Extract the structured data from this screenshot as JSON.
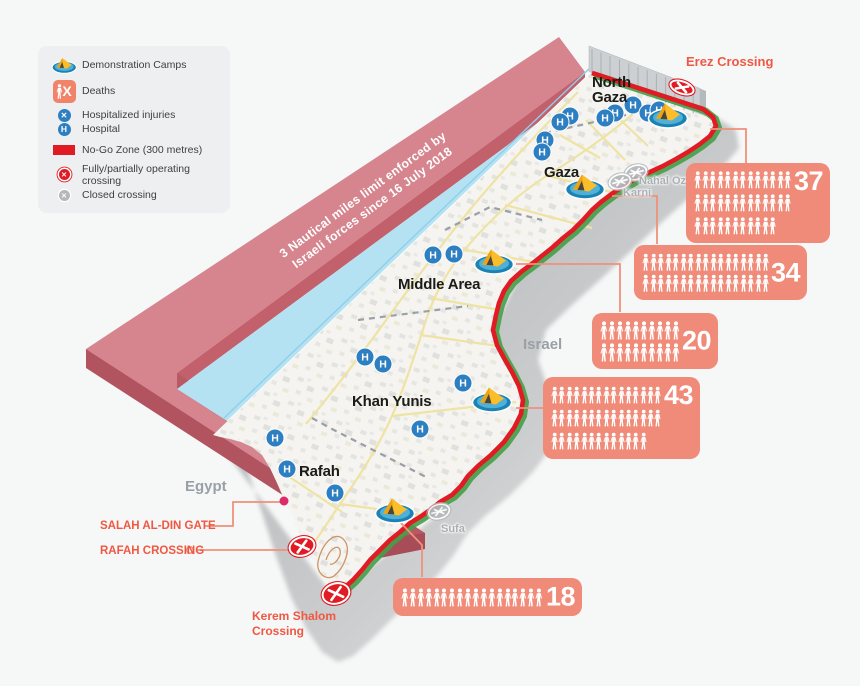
{
  "legend": {
    "items": [
      {
        "icon": "tent-icon",
        "label": "Demonstration Camps"
      },
      {
        "icon": "deaths-icon",
        "label": "Deaths"
      },
      {
        "icon": "injury-icon",
        "label": "Hospitalized injuries"
      },
      {
        "icon": "hospital-icon",
        "label": "Hospital"
      },
      {
        "icon": "nogo-icon",
        "label": "No-Go Zone (300 metres)"
      },
      {
        "icon": "operating-crossing-icon",
        "label": "Fully/partially operating crossing"
      },
      {
        "icon": "closed-crossing-icon",
        "label": "Closed crossing"
      }
    ]
  },
  "sea_band": {
    "label": "3 Nautical miles limit enforced by\nIsraeli forces since 16 July 2018"
  },
  "regions": [
    {
      "name": "North\nGaza",
      "x": 592,
      "y": 76
    },
    {
      "name": "Gaza",
      "x": 544,
      "y": 166
    },
    {
      "name": "Middle Area",
      "x": 398,
      "y": 278
    },
    {
      "name": "Khan Yunis",
      "x": 352,
      "y": 395
    },
    {
      "name": "Rafah",
      "x": 299,
      "y": 465
    }
  ],
  "countries": [
    {
      "name": "Israel",
      "x": 523,
      "y": 336
    },
    {
      "name": "Egypt",
      "x": 185,
      "y": 478
    }
  ],
  "crossing_labels": [
    {
      "id": "erez",
      "name": "Erez Crossing",
      "x": 686,
      "y": 54,
      "size": 13
    },
    {
      "id": "salah-al-din-gate",
      "name": "SALAH AL-DIN GATE",
      "x": 100,
      "y": 519,
      "size": 11.5
    },
    {
      "id": "rafah-crossing",
      "name": "RAFAH CROSSING",
      "x": 100,
      "y": 544,
      "size": 11.5
    },
    {
      "id": "kerem-shalom",
      "name": "Kerem Shalom\nCrossing",
      "x": 252,
      "y": 609,
      "size": 12
    }
  ],
  "closed_crossings": [
    {
      "name": "Nahal Oz",
      "icon_x": 636,
      "icon_y": 175,
      "label_x": 639,
      "label_y": 175
    },
    {
      "name": "Karni",
      "icon_x": 620,
      "icon_y": 184,
      "label_x": 623,
      "label_y": 187
    },
    {
      "name": "Sufa",
      "icon_x": 439,
      "icon_y": 514,
      "label_x": 441,
      "label_y": 523
    }
  ],
  "operating_crossings": [
    {
      "id": "erez-crossing-marker",
      "x": 682,
      "y": 90,
      "rx": 12,
      "ry": 6,
      "rot": 20
    },
    {
      "id": "rafah-crossing-marker",
      "x": 302,
      "y": 549,
      "rx": 12.5,
      "ry": 9,
      "rot": -15
    },
    {
      "id": "kerem-shalom-crossing-marker",
      "x": 336,
      "y": 596,
      "rx": 13.5,
      "ry": 10,
      "rot": -15
    }
  ],
  "gate_marker": {
    "x": 284,
    "y": 501
  },
  "camps": [
    {
      "x": 668,
      "y": 117
    },
    {
      "x": 585,
      "y": 188
    },
    {
      "x": 494,
      "y": 263
    },
    {
      "x": 492,
      "y": 401
    },
    {
      "x": 395,
      "y": 512
    }
  ],
  "hospitals": [
    {
      "x": 633,
      "y": 105
    },
    {
      "x": 648,
      "y": 113
    },
    {
      "x": 659,
      "y": 110
    },
    {
      "x": 615,
      "y": 113
    },
    {
      "x": 605,
      "y": 118
    },
    {
      "x": 570,
      "y": 116
    },
    {
      "x": 560,
      "y": 122
    },
    {
      "x": 545,
      "y": 140
    },
    {
      "x": 542,
      "y": 152
    },
    {
      "x": 433,
      "y": 255
    },
    {
      "x": 454,
      "y": 254
    },
    {
      "x": 365,
      "y": 357
    },
    {
      "x": 383,
      "y": 364
    },
    {
      "x": 463,
      "y": 383
    },
    {
      "x": 420,
      "y": 429
    },
    {
      "x": 275,
      "y": 438
    },
    {
      "x": 287,
      "y": 469
    },
    {
      "x": 335,
      "y": 493
    }
  ],
  "hospital_glyph": "H",
  "stats": [
    {
      "value": "37",
      "rows": [
        13,
        13,
        11
      ],
      "x": 686,
      "y": 163,
      "w": 144,
      "h": 80,
      "num_pos": "top"
    },
    {
      "value": "34",
      "rows": [
        17,
        17
      ],
      "x": 634,
      "y": 245,
      "w": 173,
      "h": 55,
      "num_pos": "mid"
    },
    {
      "value": "20",
      "rows": [
        10,
        10
      ],
      "x": 592,
      "y": 313,
      "w": 126,
      "h": 56,
      "num_pos": "mid"
    },
    {
      "value": "43",
      "rows": [
        15,
        15,
        13
      ],
      "x": 543,
      "y": 377,
      "w": 157,
      "h": 82,
      "num_pos": "top"
    },
    {
      "value": "18",
      "rows": [
        18
      ],
      "x": 393,
      "y": 578,
      "w": 189,
      "h": 38,
      "num_pos": "mid"
    }
  ],
  "colors": {
    "accent_label": "#f05843",
    "stat_box": "#ef8b78",
    "nogo_red": "#e11b24",
    "hospital_blue": "#2e7fc2",
    "sea": "#b5e2f2",
    "band": "#d6858e",
    "closed_gray": "#b3b8bc",
    "gate_dot": "#de2a68"
  }
}
